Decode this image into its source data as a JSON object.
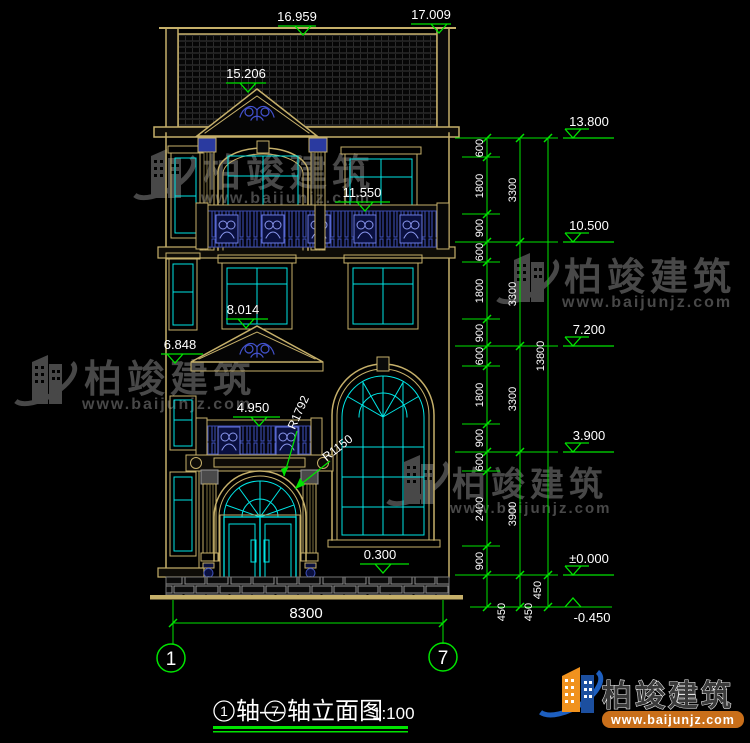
{
  "drawing": {
    "elevations": {
      "left": [
        "16.959",
        "15.206",
        "11.550",
        "8.014",
        "6.848",
        "4.950",
        "0.300"
      ],
      "top_right": "17.009",
      "right": [
        "13.800",
        "10.500",
        "7.200",
        "3.900",
        "±0.000",
        "-0.450"
      ]
    },
    "radii": [
      "R1792",
      "R1150"
    ],
    "dims": {
      "col1": [
        "600",
        "1800",
        "900",
        "600",
        "1800",
        "900",
        "600",
        "1800",
        "900",
        "600",
        "2400",
        "900"
      ],
      "col2": [
        "3300",
        "3300",
        "3300",
        "3900"
      ],
      "col3": [
        "13800"
      ],
      "bottom450": [
        "450",
        "450",
        "450"
      ],
      "width": "8300"
    },
    "axes": {
      "left": "1",
      "right": "7"
    },
    "title": {
      "axis1": "1",
      "joiner": "轴—",
      "axis2": "7",
      "suffix": "轴立面图",
      "scale": "1:100"
    }
  },
  "watermark": {
    "name": "柏竣建筑",
    "url": "www.baijunjz.com"
  },
  "brand": {
    "name": "柏竣建筑",
    "url": "www.baijunjz.com"
  },
  "colors": {
    "line_tan": "#c6b06a",
    "glass_cyan": "#00e5e5",
    "dim_green": "#00e400",
    "rail_blue": "#4053c0",
    "text_white": "#ffffff"
  }
}
